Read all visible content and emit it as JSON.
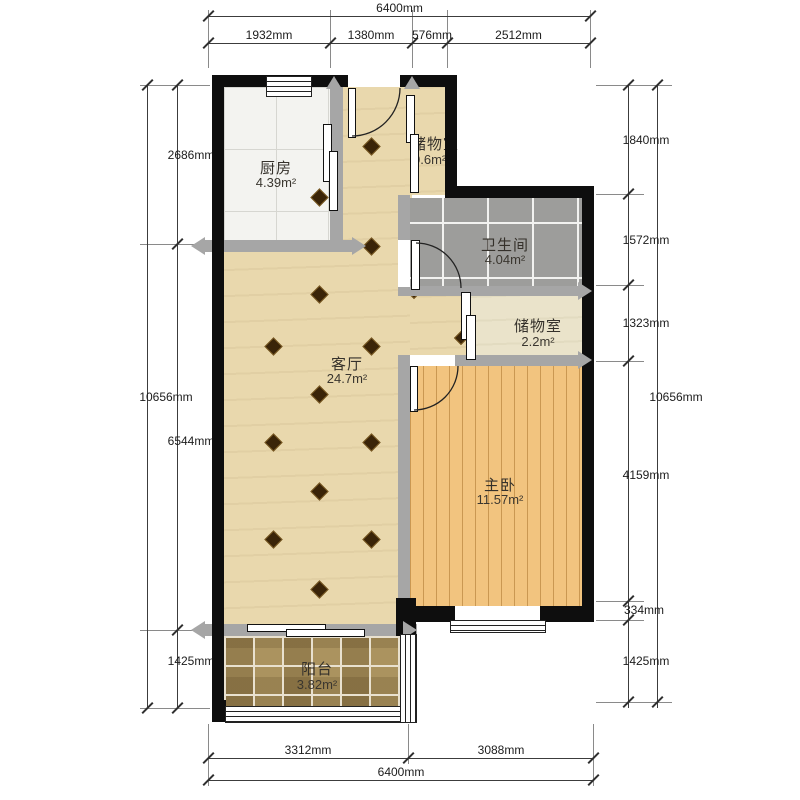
{
  "rooms": {
    "kitchen": {
      "name": "厨房",
      "area": "4.39m²"
    },
    "storage_top": {
      "name": "储物室",
      "area": "0.6m²"
    },
    "bathroom": {
      "name": "卫生间",
      "area": "4.04m²"
    },
    "storage_mid": {
      "name": "储物室",
      "area": "2.2m²"
    },
    "living": {
      "name": "客厅",
      "area": "24.7m²"
    },
    "bedroom": {
      "name": "主卧",
      "area": "11.57m²"
    },
    "balcony": {
      "name": "阳台",
      "area": "3.82m²"
    }
  },
  "dimensions": {
    "top": {
      "total": "6400mm",
      "segments": [
        "1932mm",
        "1380mm",
        "576mm",
        "2512mm"
      ]
    },
    "bottom": {
      "total": "6400mm",
      "segments": [
        "3312mm",
        "3088mm"
      ]
    },
    "left": {
      "total": "10656mm",
      "segments": [
        "2686mm",
        "6544mm",
        "1425mm"
      ]
    },
    "right": {
      "total": "10656mm",
      "segments": [
        "1840mm",
        "1572mm",
        "1323mm",
        "4159mm",
        "334mm",
        "1425mm"
      ]
    }
  },
  "colors": {
    "wall": "#0e0e0e",
    "partition": "#a6a6a6",
    "living_floor": "#e9d8ad",
    "bedroom_floor": "#f2c47f",
    "bathroom_tile": "#9d9d9b",
    "balcony_tile": "#ab935f",
    "storage_floor": "#eae3ca",
    "kitchen_tile": "#f3f3f0"
  }
}
